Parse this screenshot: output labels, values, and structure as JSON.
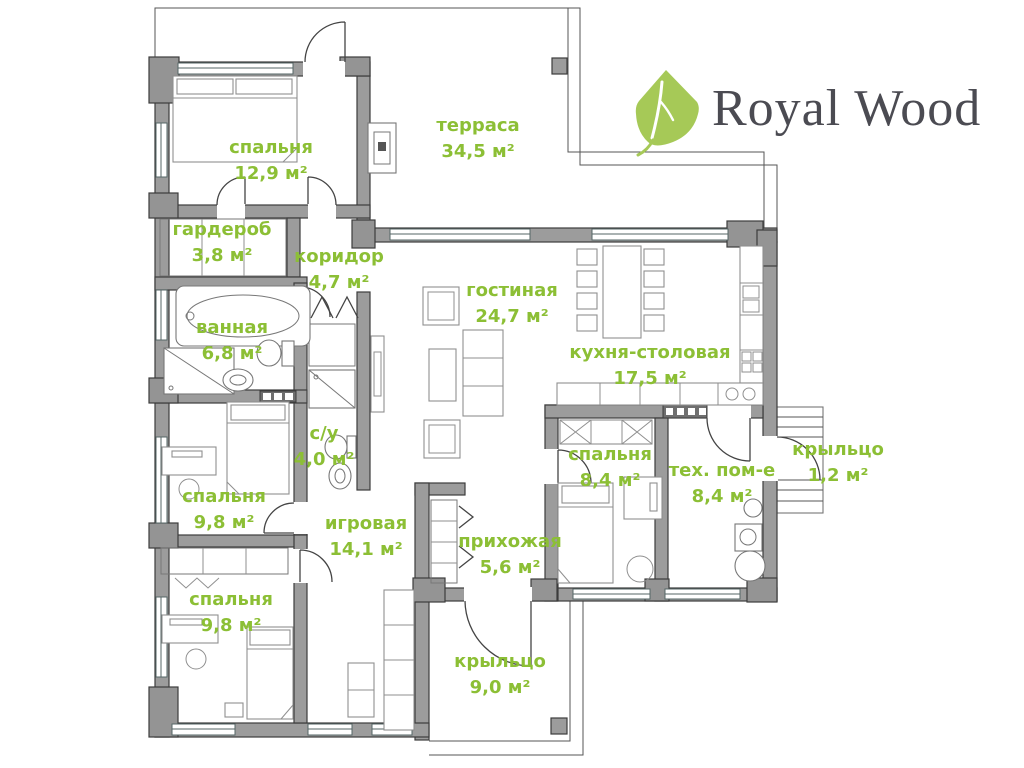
{
  "logo": {
    "brand": "Royal Wood"
  },
  "colors": {
    "label_green": "#8cbf35",
    "wall_fill": "#9c9c9c",
    "wall_stroke": "#3c3c3c",
    "leaf_green": "#a6c957",
    "logo_text": "#4b4b52"
  },
  "rooms": [
    {
      "id": "bedroom-1",
      "name": "спальня",
      "area": "12,9 м²"
    },
    {
      "id": "terrace",
      "name": "терраса",
      "area": "34,5 м²"
    },
    {
      "id": "wardrobe",
      "name": "гардероб",
      "area": "3,8 м²"
    },
    {
      "id": "corridor",
      "name": "коридор",
      "area": "4,7 м²"
    },
    {
      "id": "bathroom",
      "name": "ванная",
      "area": "6,8 м²"
    },
    {
      "id": "living-room",
      "name": "гостиная",
      "area": "24,7 м²"
    },
    {
      "id": "kitchen",
      "name": "кухня-столовая",
      "area": "17,5 м²"
    },
    {
      "id": "wc",
      "name": "с/у",
      "area": "4,0 м²"
    },
    {
      "id": "bedroom-2",
      "name": "спальня",
      "area": "9,8 м²"
    },
    {
      "id": "playroom",
      "name": "игровая",
      "area": "14,1 м²"
    },
    {
      "id": "hallway",
      "name": "прихожая",
      "area": "5,6 м²"
    },
    {
      "id": "bedroom-3",
      "name": "спальня",
      "area": "8,4 м²"
    },
    {
      "id": "tech-room",
      "name": "тех. пом-е",
      "area": "8,4 м²"
    },
    {
      "id": "porch-side",
      "name": "крыльцо",
      "area": "1,2 м²"
    },
    {
      "id": "bedroom-4",
      "name": "спальня",
      "area": "9,8 м²"
    },
    {
      "id": "porch-main",
      "name": "крыльцо",
      "area": "9,0 м²"
    }
  ]
}
